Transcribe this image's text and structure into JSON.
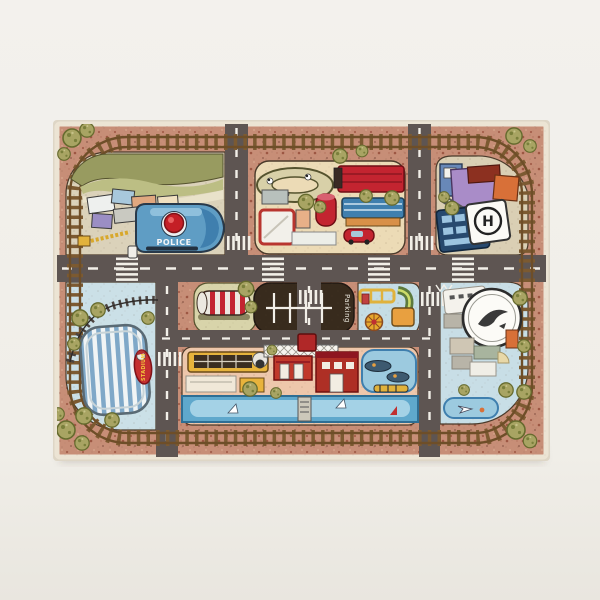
{
  "scene": {
    "type": "product-photo",
    "background_color": "#f1efea"
  },
  "rug": {
    "labels": {
      "police": "POLICE",
      "parking": "Parking",
      "stadium": "STADIUM",
      "helipad": "H"
    },
    "colors": {
      "base_terracotta": "#c78e77",
      "binding_cream": "#ece4d4",
      "railway_brown": "#7c5a31",
      "road_gray": "#5e5552",
      "marking_white": "#f2efe8",
      "water_blue": "#5fa8cc",
      "tree_olive": "#a8a463",
      "police_blue": "#5f9dc4",
      "fire_red": "#c0392b",
      "stadium_stripe_blue": "#7fa8c8",
      "parking_brown": "#382b1d",
      "block_beige": "#ecdbb6",
      "block_lightblue": "#c8dee6",
      "block_peach": "#eec7ab"
    }
  }
}
